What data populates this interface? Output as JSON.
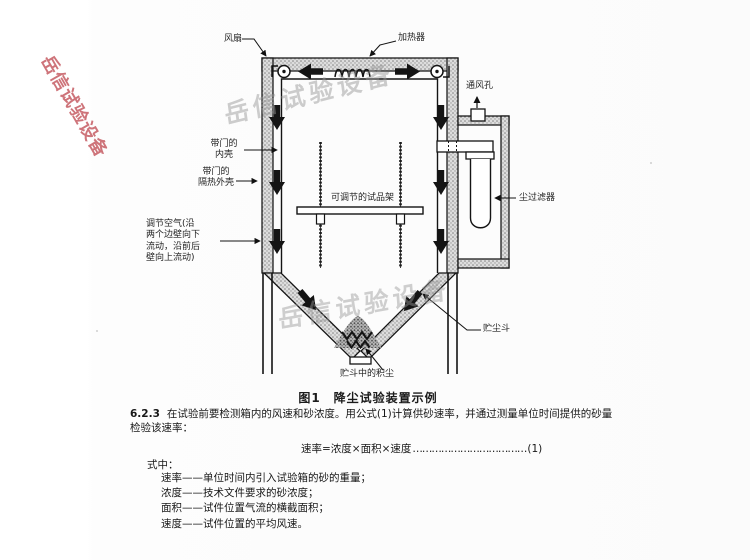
{
  "watermarks": {
    "text": "岳信试验设备",
    "red_color": "#c04d55",
    "gray_color": "#969696"
  },
  "figure": {
    "caption": "图1　降尘试验装置示例",
    "labels": {
      "fan": "风扇",
      "heater": "加热器",
      "vent": "通风孔",
      "inner_shell": "带门的\n内壳",
      "outer_shell": "带门的\n隔热外壳",
      "air": "调节空气(沿\n两个边壁向下\n流动，沿前后\n壁向上流动)",
      "rack": "可调节的试品架",
      "filter": "尘过滤器",
      "hopper": "贮尘斗",
      "dust": "贮斗中的积尘"
    }
  },
  "body": {
    "clause_number": "6.2.3",
    "clause_text": "在试验前要检测箱内的风速和砂浓度。用公式(1)计算供砂速率，并通过测量单位时间提供的砂量检验该速率：",
    "formula_lhs": "速率=浓度×面积×速度",
    "formula_dots": "………………………………",
    "formula_no": "(1)",
    "where_label": "式中：",
    "definitions": [
      "速率——单位时间内引入试验箱的砂的重量；",
      "浓度——技术文件要求的砂浓度；",
      "面积——试件位置气流的横截面积；",
      "速度——试件位置的平均风速。"
    ]
  }
}
